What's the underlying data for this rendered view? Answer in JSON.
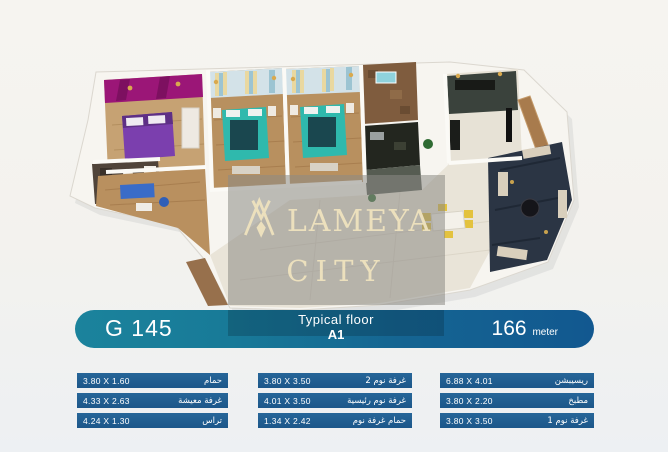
{
  "watermark": {
    "logo": "alameya-monogram",
    "line1": "LAMEYA",
    "line2": "CITY",
    "brand": "ALAMEYA CITY",
    "text_color": "#ece0bd"
  },
  "header": {
    "unit_code": "G 145",
    "floor_label": "Typical floor",
    "floor_code": "A1",
    "area_value": "166",
    "area_unit": "meter",
    "bar_color_left": "#1b839c",
    "bar_color_right": "#125890"
  },
  "table": {
    "row_color": "#205d90",
    "columns": [
      {
        "rows": [
          {
            "dims": "3.80 X 1.60",
            "label": "حمام"
          },
          {
            "dims": "4.33 X 2.63",
            "label": "غرفة معيشة"
          },
          {
            "dims": "4.24 X 1.30",
            "label": "تراس"
          }
        ]
      },
      {
        "rows": [
          {
            "dims": "3.80 X 3.50",
            "label": "غرفة نوم 2"
          },
          {
            "dims": "4.01 X 3.50",
            "label": "غرفة نوم رئيسية"
          },
          {
            "dims": "1.34 X 2.42",
            "label": "حمام غرفة نوم"
          }
        ]
      },
      {
        "rows": [
          {
            "dims": "6.88 X 4.01",
            "label": "ريسيبشن"
          },
          {
            "dims": "3.80 X 2.20",
            "label": "مطبخ"
          },
          {
            "dims": "3.80 X 3.50",
            "label": "غرفة نوم 1"
          }
        ]
      }
    ]
  }
}
